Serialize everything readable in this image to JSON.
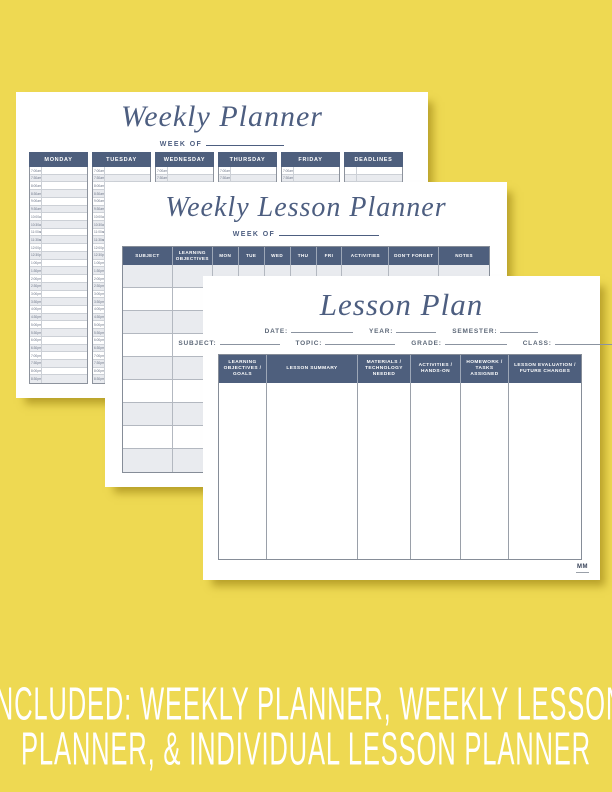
{
  "background_color": "#EED952",
  "accent_color": "#4E5F7D",
  "row_alt_color": "#E9EBEF",
  "weekly_planner": {
    "title": "Weekly Planner",
    "week_of_label": "WEEK OF",
    "columns": [
      "MONDAY",
      "TUESDAY",
      "WEDNESDAY",
      "THURSDAY",
      "FRIDAY",
      "DEADLINES"
    ],
    "times": [
      "7:00am",
      "7:30am",
      "8:00am",
      "8:30am",
      "9:00am",
      "9:30am",
      "10:00am",
      "10:30am",
      "11:00am",
      "11:30am",
      "12:00pm",
      "12:30pm",
      "1:00pm",
      "1:30pm",
      "2:00pm",
      "2:30pm",
      "3:00pm",
      "3:30pm",
      "4:00pm",
      "4:30pm",
      "5:00pm",
      "5:30pm",
      "6:00pm",
      "6:30pm",
      "7:00pm",
      "7:30pm",
      "8:00pm",
      "8:30pm"
    ]
  },
  "weekly_lesson_planner": {
    "title": "Weekly Lesson Planner",
    "week_of_label": "WEEK OF",
    "columns": [
      "SUBJECT",
      "LEARNING OBJECTIVES",
      "MON",
      "TUE",
      "WED",
      "THU",
      "FRI",
      "ACTIVITIES",
      "DON'T FORGET",
      "NOTES"
    ],
    "row_count": 9
  },
  "lesson_plan": {
    "title": "Lesson Plan",
    "fields_row1": [
      "DATE:",
      "YEAR:",
      "SEMESTER:"
    ],
    "fields_row2": [
      "SUBJECT:",
      "TOPIC:",
      "GRADE:",
      "CLASS:"
    ],
    "columns": [
      "LEARNING OBJECTIVES / GOALS",
      "LESSON SUMMARY",
      "MATERIALS / TECHNOLOGY NEEDED",
      "ACTIVITIES / HANDS-ON",
      "HOMEWORK / TASKS ASSIGNED",
      "LESSON EVALUATION / FUTURE CHANGES"
    ],
    "logo_monogram": "MM"
  },
  "caption": {
    "line1": "INCLUDED: WEEKLY PLANNER, WEEKLY LESSON",
    "line2": "PLANNER, & INDIVIDUAL LESSON PLANNER"
  }
}
